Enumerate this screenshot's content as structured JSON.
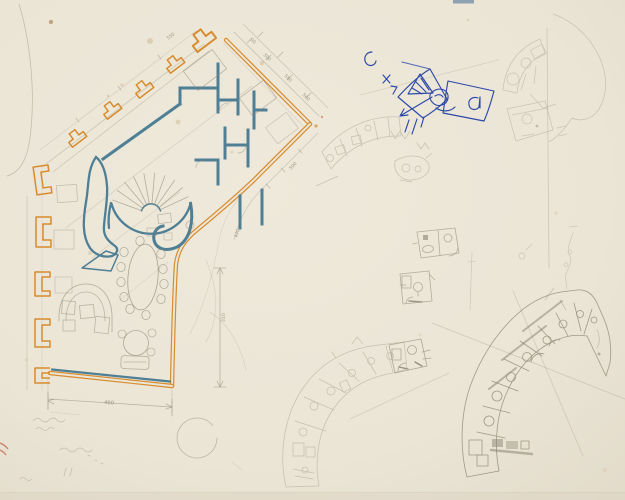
{
  "meta": {
    "title": "Architectural floor-plan sketch on tracing paper",
    "media": "orange and blue colored pencil, blue ballpoint and graphite on cream paper"
  },
  "colors": {
    "paper": "#ece6d8",
    "paper_mid": "#e9e3d4",
    "paper_edge": "#ddd6c5",
    "orange_wall": "#d78c2e",
    "blue_wall": "#4e7f95",
    "ballpoint": "#2c49a8",
    "pencil": "#8f8674",
    "pencil_light": "#a69d8a",
    "pencil_dark": "#6b6354",
    "stain": "#c4a06a",
    "red_mark": "#bb4f2c",
    "sheet_tab": "#8ea3b2"
  },
  "main_plan": {
    "dimensions": {
      "bottom": "400",
      "right_side": "310",
      "facade_ticks": [
        "550",
        "90",
        "300",
        "580",
        "560",
        "590",
        "440"
      ]
    }
  }
}
